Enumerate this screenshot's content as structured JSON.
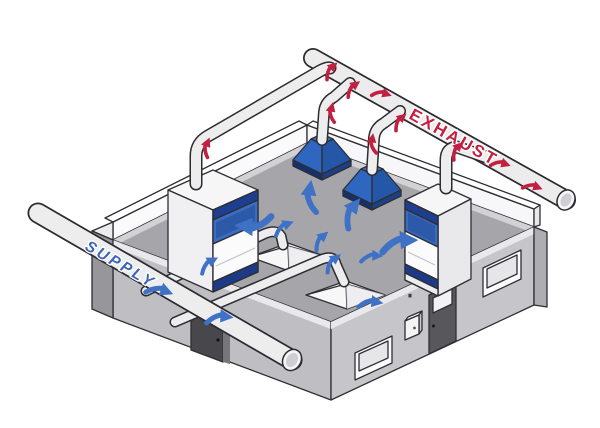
{
  "diagram": {
    "type": "isometric-lab-ventilation-diagram",
    "labels": {
      "supply": "SUPPLY",
      "exhaust": "EXHAUST"
    },
    "colors": {
      "outline": "#2e2e33",
      "duct_fill": "#ededee",
      "floor": "#a6a6aa",
      "walkway_strip": "#d2d2d5",
      "front_wall_right": "#c6c6ca",
      "front_wall_left": "#bfbfc3",
      "building_end_wall": "#97979b",
      "parapet_wall": "#fafafa",
      "hood_body": "#f4f4f5",
      "sash_header": "#1e3e8f",
      "sash_panel": "#3a6cc0",
      "sash_sill": "#1c3a85",
      "canopy_light_face": "#2e66c0",
      "canopy_shaded_face": "#2457a8",
      "canopy_base": "#14316e",
      "side_door": "#48484c",
      "front_door": "#58585c",
      "supply_label_color": "#3d63b8",
      "exhaust_label_color": "#c41f3f",
      "supply_arrow_color": "#3f72c4",
      "exhaust_arrow_color": "#c22040"
    },
    "components": [
      {
        "name": "supply-duct",
        "label": "SUPPLY"
      },
      {
        "name": "exhaust-duct",
        "label": "EXHAUST"
      },
      {
        "name": "fume-hood-left"
      },
      {
        "name": "fume-hood-right"
      },
      {
        "name": "canopy-hood-1"
      },
      {
        "name": "canopy-hood-2"
      },
      {
        "name": "floor-diffuser-1"
      },
      {
        "name": "floor-diffuser-2"
      },
      {
        "name": "room-shell"
      },
      {
        "name": "side-door"
      },
      {
        "name": "front-door"
      },
      {
        "name": "front-window-1"
      },
      {
        "name": "front-window-2"
      },
      {
        "name": "control-panel"
      }
    ],
    "airflow": {
      "supply_arrow_count": 12,
      "exhaust_arrow_count": 10
    }
  }
}
